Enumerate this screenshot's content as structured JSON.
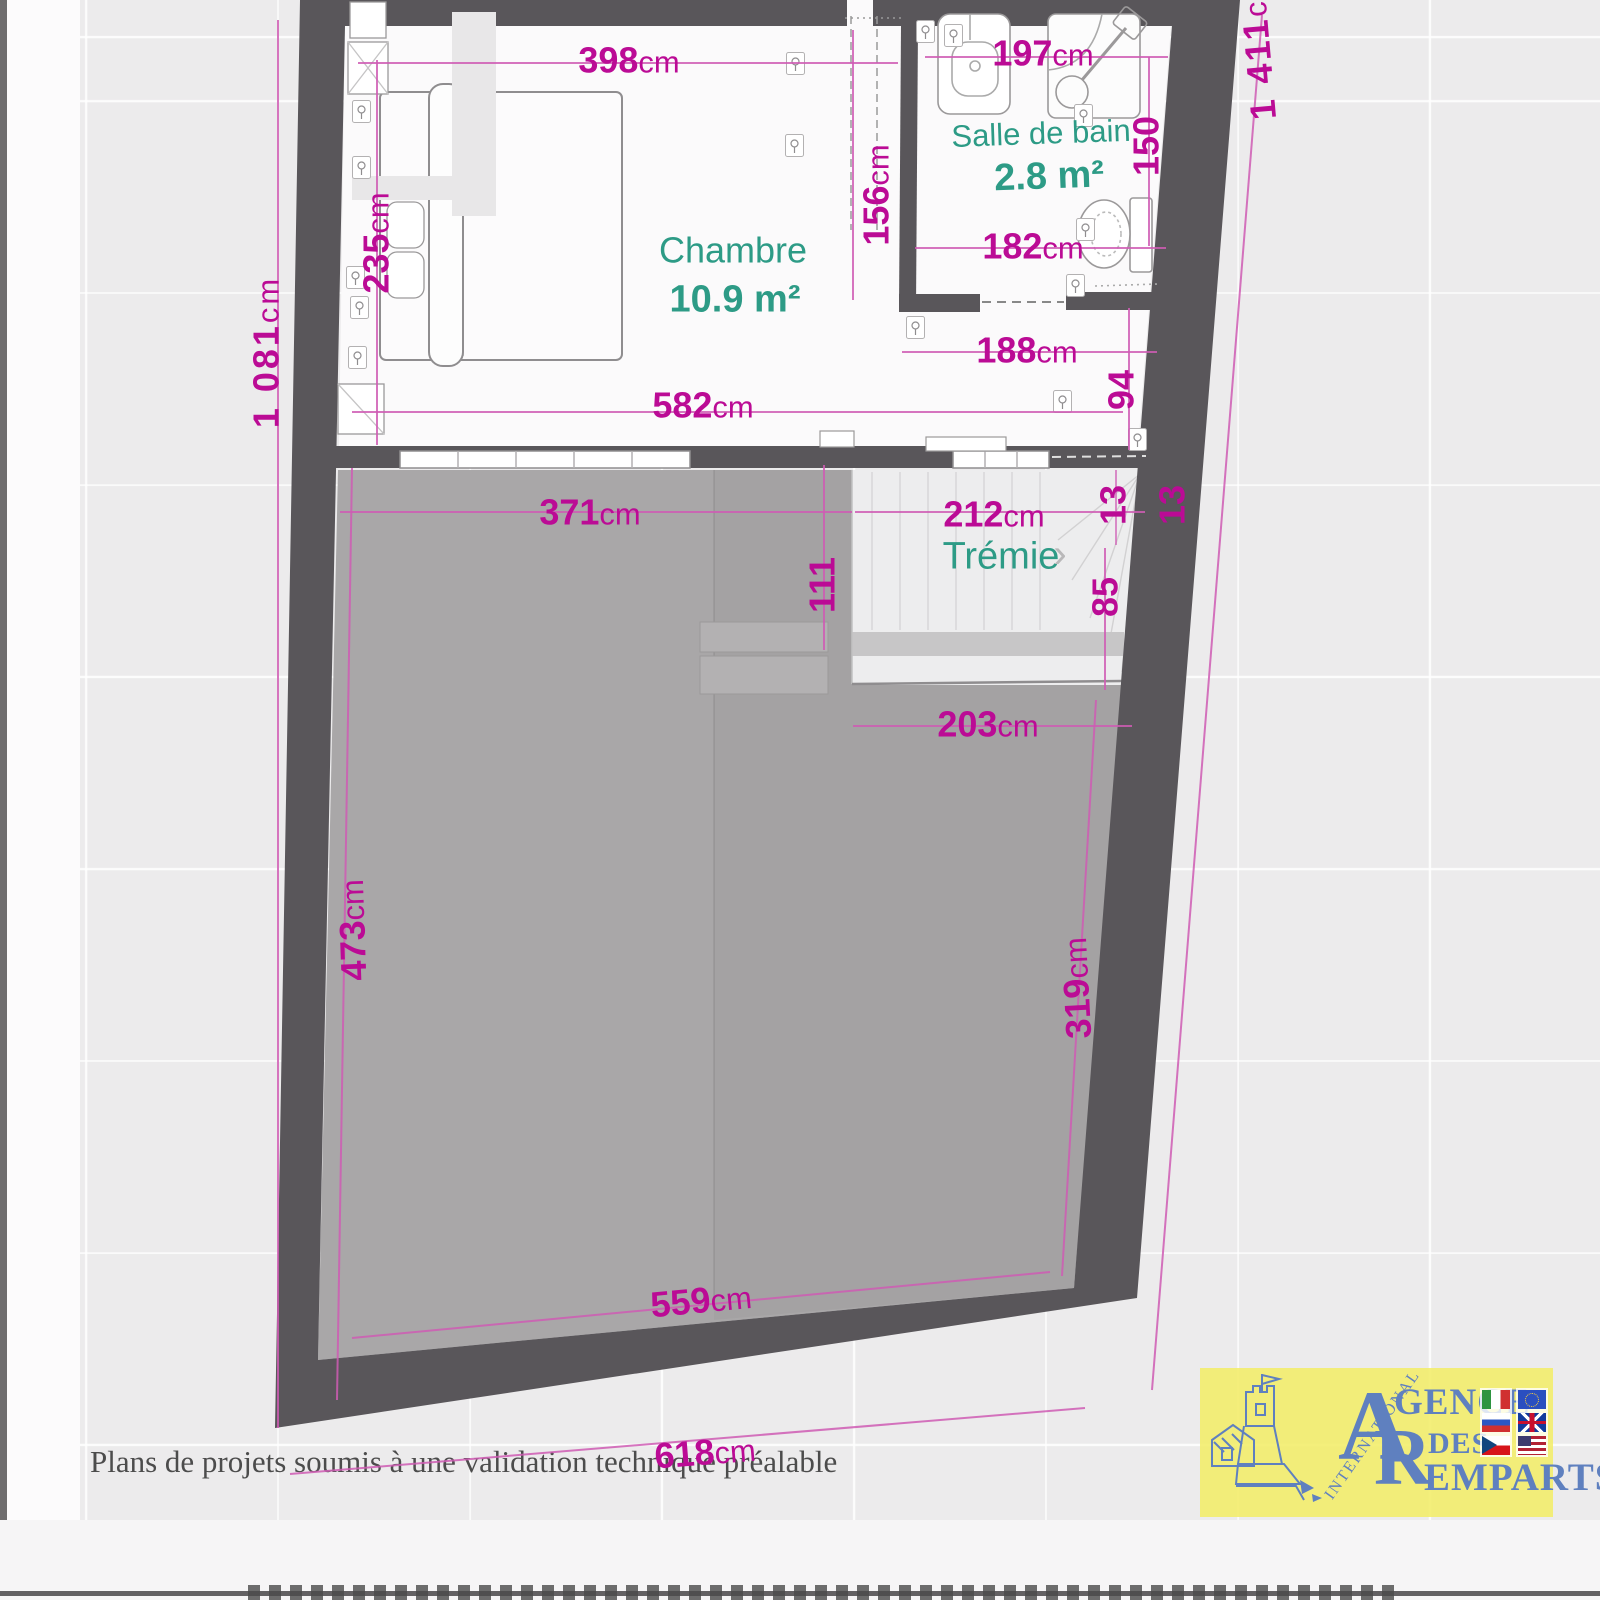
{
  "plan": {
    "rooms": [
      {
        "name": "Chambre",
        "area": "10.9 m²"
      },
      {
        "name": "Salle de bain",
        "area": "2.8 m²"
      },
      {
        "name": "Trémie",
        "area": ""
      }
    ],
    "tremie_arrow": "›",
    "dims": {
      "w398": {
        "v": "398",
        "u": "cm"
      },
      "w197": {
        "v": "197",
        "u": "cm"
      },
      "v156": {
        "v": "156",
        "u": "cm"
      },
      "v235": {
        "v": "235",
        "u": "cm"
      },
      "v150": {
        "v": "150",
        "u": ""
      },
      "w182": {
        "v": "182",
        "u": "cm"
      },
      "w188": {
        "v": "188",
        "u": "cm"
      },
      "v94": {
        "v": "94",
        "u": ""
      },
      "w582": {
        "v": "582",
        "u": "cm"
      },
      "w371": {
        "v": "371",
        "u": "cm"
      },
      "w212": {
        "v": "212",
        "u": "cm"
      },
      "v111": {
        "v": "111",
        "u": ""
      },
      "v13a": {
        "v": "13",
        "u": ""
      },
      "v13b": {
        "v": "13",
        "u": ""
      },
      "v85": {
        "v": "85",
        "u": ""
      },
      "w203": {
        "v": "203",
        "u": "cm"
      },
      "v473": {
        "v": "473",
        "u": "cm"
      },
      "v319": {
        "v": "319",
        "u": "cm"
      },
      "w559": {
        "v": "559",
        "u": "cm"
      },
      "w618": {
        "v": "618",
        "u": "cm"
      },
      "v1081": {
        "v": "1 081",
        "u": "cm"
      },
      "v1411": {
        "v": "1 411",
        "u": "cm"
      }
    },
    "colors": {
      "dimension_text": "#bb0b95",
      "dimension_line": "#cf5cb4",
      "room_label": "#2d9b86",
      "wall": "#59565a",
      "void_area": "#a9a7a8"
    }
  },
  "footer": {
    "disclaimer": "Plans de projets soumis à une validation technique préalable"
  },
  "logo": {
    "international": "INTERNATIONAL",
    "a": "A",
    "gence": "GENCE",
    "des": "DES",
    "r": "R",
    "emparts": "EMPARTS",
    "flags": [
      "italy-flag",
      "eu-flag",
      "russia-flag",
      "uk-flag",
      "czech-flag",
      "usa-flag"
    ],
    "colors": {
      "background": "#f3ed69",
      "text": "#5f80bf"
    }
  }
}
